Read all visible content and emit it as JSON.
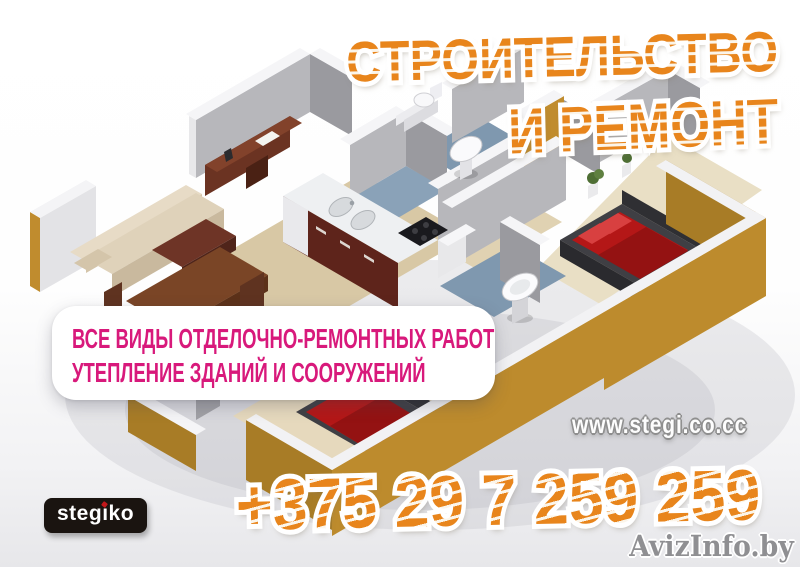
{
  "poster": {
    "title": {
      "line1": "СТРОИТЕЛЬСТВО",
      "line2": "И РЕМОНТ"
    },
    "services": {
      "line1": "ВСЕ ВИДЫ ОТДЕЛОЧНО-РЕМОНТНЫХ РАБОТ",
      "line2": "УТЕПЛЕНИЕ ЗДАНИЙ И СООРУЖЕНИЙ"
    },
    "website": "www.stegi.co.cc",
    "phone": "+375 29 7 259 259",
    "logo": "stegiko",
    "watermark": "AvizInfo.by",
    "colors": {
      "accent_orange": "#E8851C",
      "magenta": "#D8197B",
      "exterior_wall_mustard": "#BD8B2D",
      "interior_wall_gray": "#B7B7BB",
      "floor_tan": "#D8C8A5",
      "bathroom_tile_blue": "#7F98AF",
      "bed_red": "#B41717",
      "logo_bg": "#1A1410",
      "logo_dot_red": "#C2181B",
      "watermark_gray": "#8F8F92"
    },
    "illustration": "isometric-3d-apartment-floorplan"
  }
}
